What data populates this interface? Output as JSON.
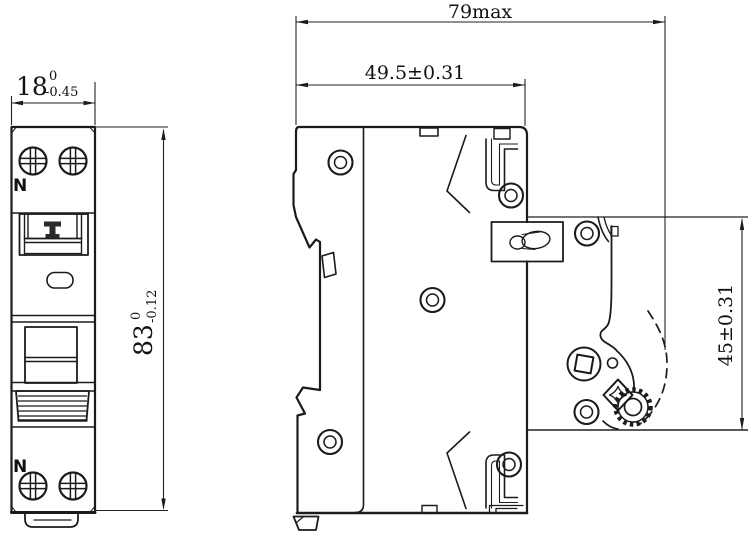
{
  "front_view": {
    "label_n_top": "N",
    "label_n_bottom": "N",
    "dim_width": {
      "value": "18",
      "tol_upper": "0",
      "tol_lower": "-0.45"
    },
    "dim_height": {
      "value": "83",
      "tol_upper": "0",
      "tol_lower": "-0.12"
    }
  },
  "side_view": {
    "dim_overall_width": "79max",
    "dim_depth": "49.5±0.31",
    "dim_rail_height": "45±0.31"
  },
  "colors": {
    "line": "#1b1b1b",
    "background": "#ffffff"
  }
}
